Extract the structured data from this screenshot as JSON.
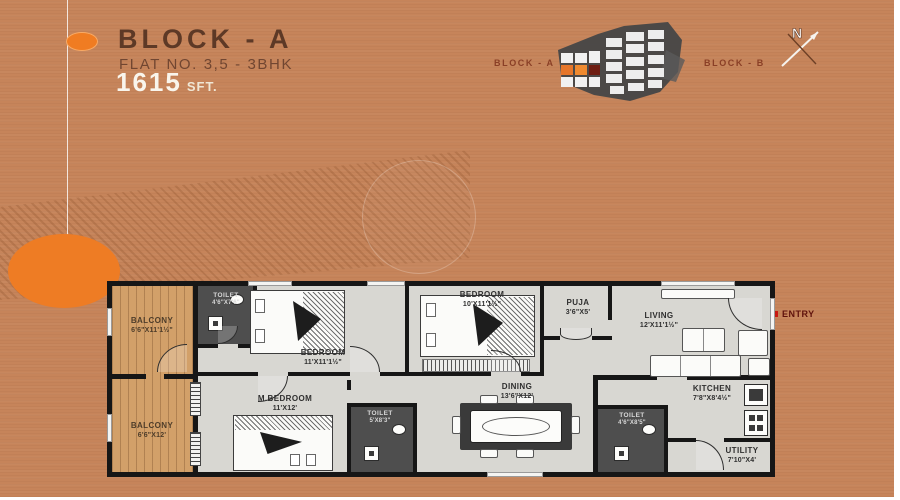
{
  "header": {
    "title": "BLOCK - A",
    "subtitle": "FLAT NO. 3,5 - 3BHK",
    "area_value": "1615",
    "area_unit": "SFT."
  },
  "keyplan": {
    "left_label": "BLOCK - A",
    "right_label": "BLOCK - B",
    "compass": "N"
  },
  "entry": {
    "label": "ENTRY"
  },
  "rooms": {
    "balcony_top": {
      "name": "BALCONY",
      "dims": "6'6\"X11'1½\""
    },
    "balcony_bottom": {
      "name": "BALCONY",
      "dims": "6'6\"X12'"
    },
    "toilet_top": {
      "name": "TOILET",
      "dims": "4'6\"X7'6\""
    },
    "bedroom_left": {
      "name": "BEDROOM",
      "dims": "11'X11'1½\""
    },
    "m_bedroom": {
      "name": "M.BEDROOM",
      "dims": "11'X12'"
    },
    "bedroom_mid": {
      "name": "BEDROOM",
      "dims": "10'X11'1½\""
    },
    "toilet_mid": {
      "name": "TOILET",
      "dims": "5'X8'3\""
    },
    "dining": {
      "name": "DINING",
      "dims": "13'6\"X12'"
    },
    "puja": {
      "name": "PUJA",
      "dims": "3'6\"X5'"
    },
    "living": {
      "name": "LIVING",
      "dims": "12'X11'1½\""
    },
    "toilet_right": {
      "name": "TOILET",
      "dims": "4'6\"X8'5\""
    },
    "kitchen": {
      "name": "KITCHEN",
      "dims": "7'8\"X8'4½\""
    },
    "utility": {
      "name": "UTILITY",
      "dims": "7'10\"X4'"
    }
  },
  "colors": {
    "background": "#c6845a",
    "accent_orange": "#ee7c24",
    "title_brown": "#5d3926",
    "wall": "#161616",
    "plan_floor": "#d8d7d2",
    "balcony_floor": "#d2a069",
    "toilet_floor": "#4e4e4e",
    "entry_red": "#c81a12",
    "keyplan_label": "#8a3f26"
  }
}
